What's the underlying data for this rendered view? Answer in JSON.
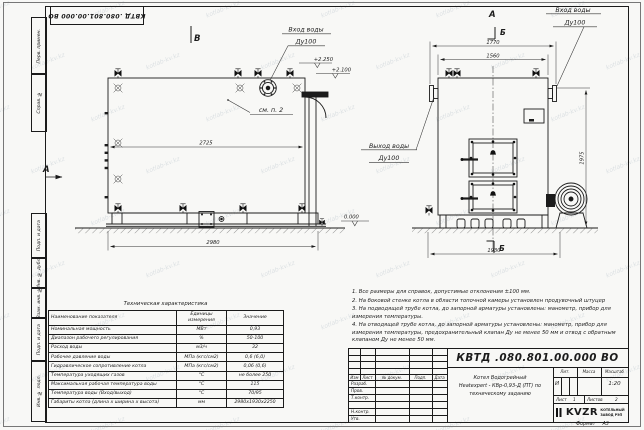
{
  "watermark": "kotlab-kv.kz",
  "side_strip": {
    "labels": [
      "Перв. примен.",
      "Справ. №",
      "Подп. и дата",
      "Инв. № дубл.",
      "Взам. инв. №",
      "Подп. и дата",
      "Инв. № подл."
    ]
  },
  "drawing": {
    "view_label_b": "В",
    "view_label_a": "А",
    "section_label_a": "А",
    "section_label_b": "Б",
    "inlet_line1": "Вход воды",
    "inlet_line2": "Ду100",
    "outlet_line1": "Выход воды",
    "outlet_line2": "Ду100",
    "see_note_ref": "см. п. 2",
    "elev_top": "+2.250",
    "elev_mid": "+2.100",
    "elev_zero": "0.000",
    "dims": {
      "side_length": "2725",
      "side_overall": "2980",
      "front_width_outer": "1770",
      "front_width": "1560",
      "front_depth": "1930",
      "front_height": "1975"
    }
  },
  "tech_table": {
    "title": "Техническая характеристика",
    "headers": [
      "Наименование показателя",
      "Единицы измерения",
      "Значение"
    ],
    "rows": [
      [
        "Номинальная мощность",
        "МВт",
        "0,93"
      ],
      [
        "Диапазон рабочего регулирования",
        "%",
        "50-100"
      ],
      [
        "Расход воды",
        "м3/ч",
        "32"
      ],
      [
        "Рабочее давление воды",
        "МПа (кгс/см2)",
        "0,6 (6,0)"
      ],
      [
        "Гидравлическое сопротивление котла",
        "МПа (кгс/см2)",
        "0,06 (0,6)"
      ],
      [
        "Температура уходящих газов",
        "°С",
        "не более 250"
      ],
      [
        "Максимальная рабочая температура воды",
        "°С",
        "115"
      ],
      [
        "Температура воды (Вход/выход)",
        "°С",
        "70/95"
      ],
      [
        "Габариты котла (длина х ширина х высота)",
        "мм",
        "2980х1930х2250"
      ]
    ]
  },
  "notes": [
    "1. Все размеры для справок, допустимые отклонения ±100 мм.",
    "2. На боковой стенке котла в области топочной камеры установлен продувочный штуцер",
    "3. На подводящей трубе котла, до запорной арматуры установлены: манометр, прибор для измерения температуры.",
    "4. На отводящей трубе котла, до запорной арматуры установлены: манометр, прибор для измерения температуры, предохранительный клапан Ду не менее 50 мм и отвод с обратным клапаном Ду не менее 50 мм."
  ],
  "title_block": {
    "doc_number": "КВТД .080.801.00.000  ВО",
    "col_headers": [
      "Изм",
      "Лист",
      "№ докум.",
      "Подп.",
      "Дата"
    ],
    "row_labels": [
      "Разраб.",
      "Пров.",
      "Т.контр.",
      "",
      "Н.контр.",
      "Утв."
    ],
    "description": [
      "Котел Водогрейный",
      "Heatexpert - КВр-0,93-Д (ПТ)  по",
      "техническому заданию"
    ],
    "lit_header": "Лит.",
    "lit_value": "И",
    "mass_header": "Масса",
    "scale_header": "Масштаб",
    "scale_value": "1:20",
    "sheet_label": "Лист",
    "sheet_value": "1",
    "sheets_label": "Листов",
    "sheets_value": "2",
    "company_logo": "KVZR",
    "company_name": [
      "КОТЕЛЬНЫЙ",
      "ЗАВОД РЭП"
    ],
    "format_label": "Формат",
    "format_value": "А3"
  }
}
